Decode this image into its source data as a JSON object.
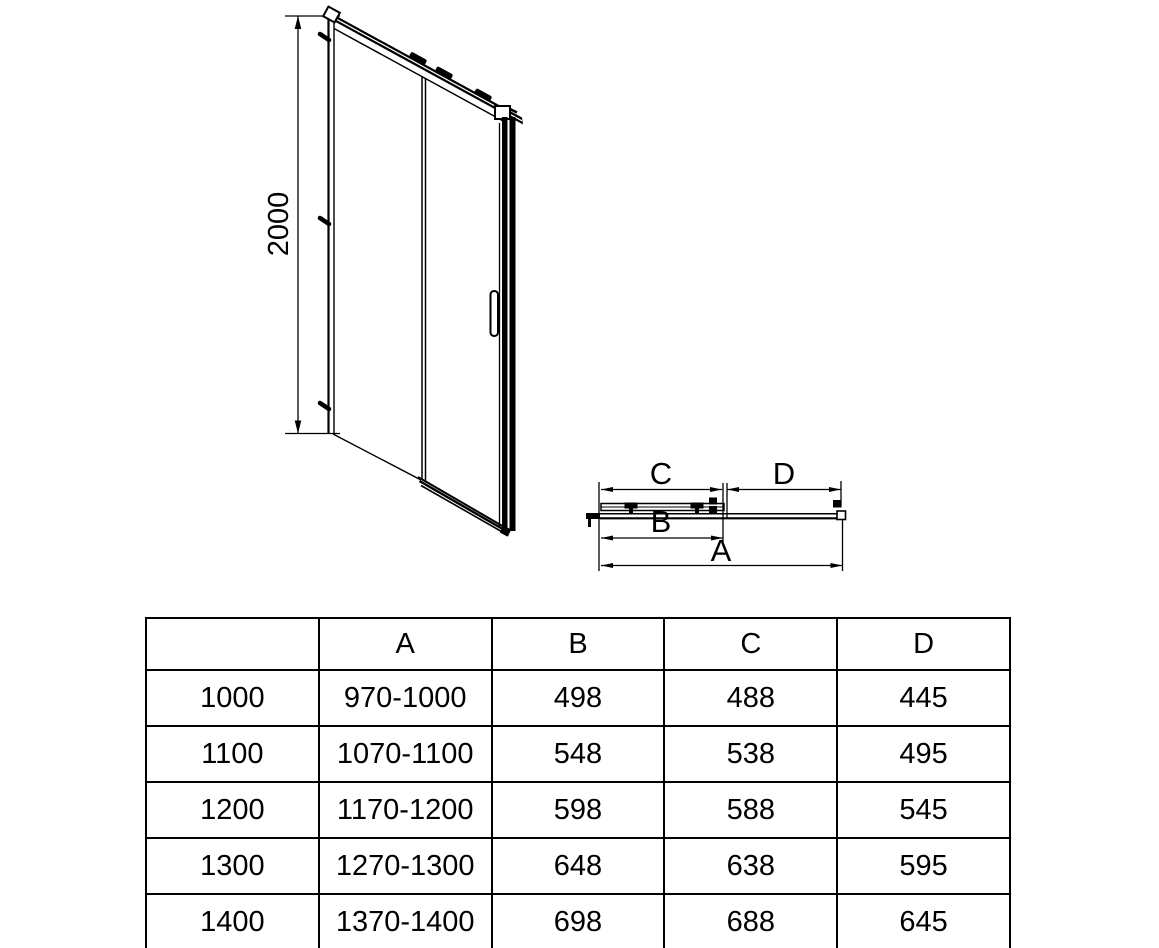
{
  "colors": {
    "line": "#000000",
    "background": "#ffffff"
  },
  "elevation": {
    "height_dim": "2000"
  },
  "plan": {
    "dim_c": "C",
    "dim_d": "D",
    "dim_b": "B",
    "dim_a": "A"
  },
  "table": {
    "headers": [
      "",
      "A",
      "B",
      "C",
      "D"
    ],
    "rows": [
      [
        "1000",
        "970-1000",
        "498",
        "488",
        "445"
      ],
      [
        "1100",
        "1070-1100",
        "548",
        "538",
        "495"
      ],
      [
        "1200",
        "1170-1200",
        "598",
        "588",
        "545"
      ],
      [
        "1300",
        "1270-1300",
        "648",
        "638",
        "595"
      ],
      [
        "1400",
        "1370-1400",
        "698",
        "688",
        "645"
      ]
    ]
  }
}
